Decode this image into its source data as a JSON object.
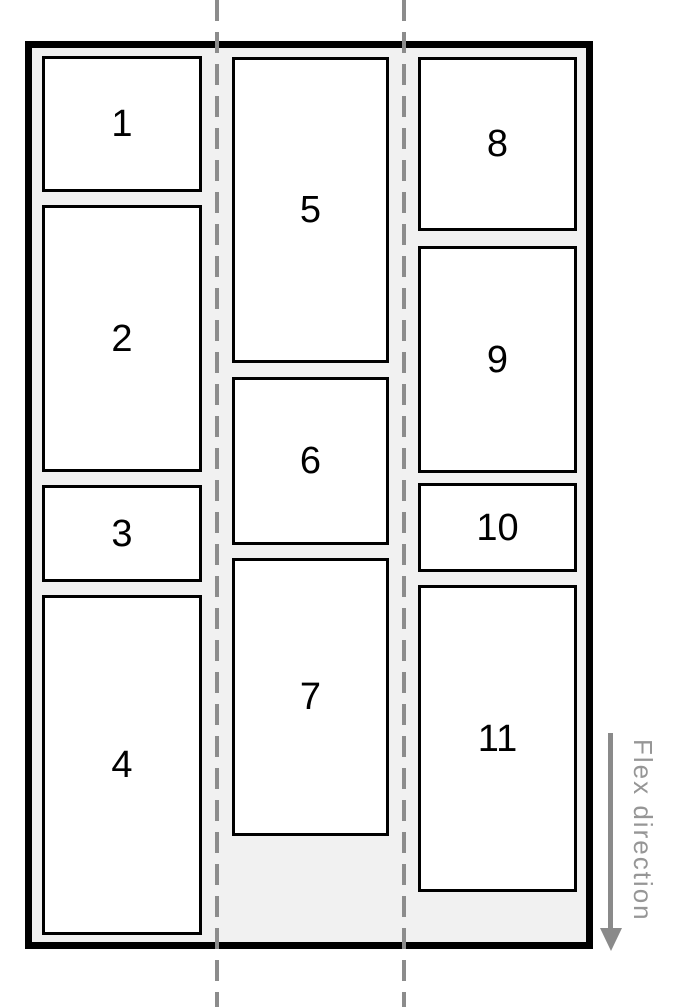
{
  "diagram": {
    "kind": "flexbox-column-wrap-illustration",
    "flex_direction_label": "Flex direction",
    "columns": [
      {
        "items": [
          "1",
          "2",
          "3",
          "4"
        ]
      },
      {
        "items": [
          "5",
          "6",
          "7"
        ]
      },
      {
        "items": [
          "8",
          "9",
          "10",
          "11"
        ]
      }
    ],
    "colors": {
      "container_background": "#f1f1f1",
      "container_border": "#000000",
      "item_background": "#ffffff",
      "item_border": "#000000",
      "item_text": "#000000",
      "dashed_guide": "#8c8c8c",
      "arrow": "#8a8a8a",
      "label_text": "#969696"
    }
  }
}
